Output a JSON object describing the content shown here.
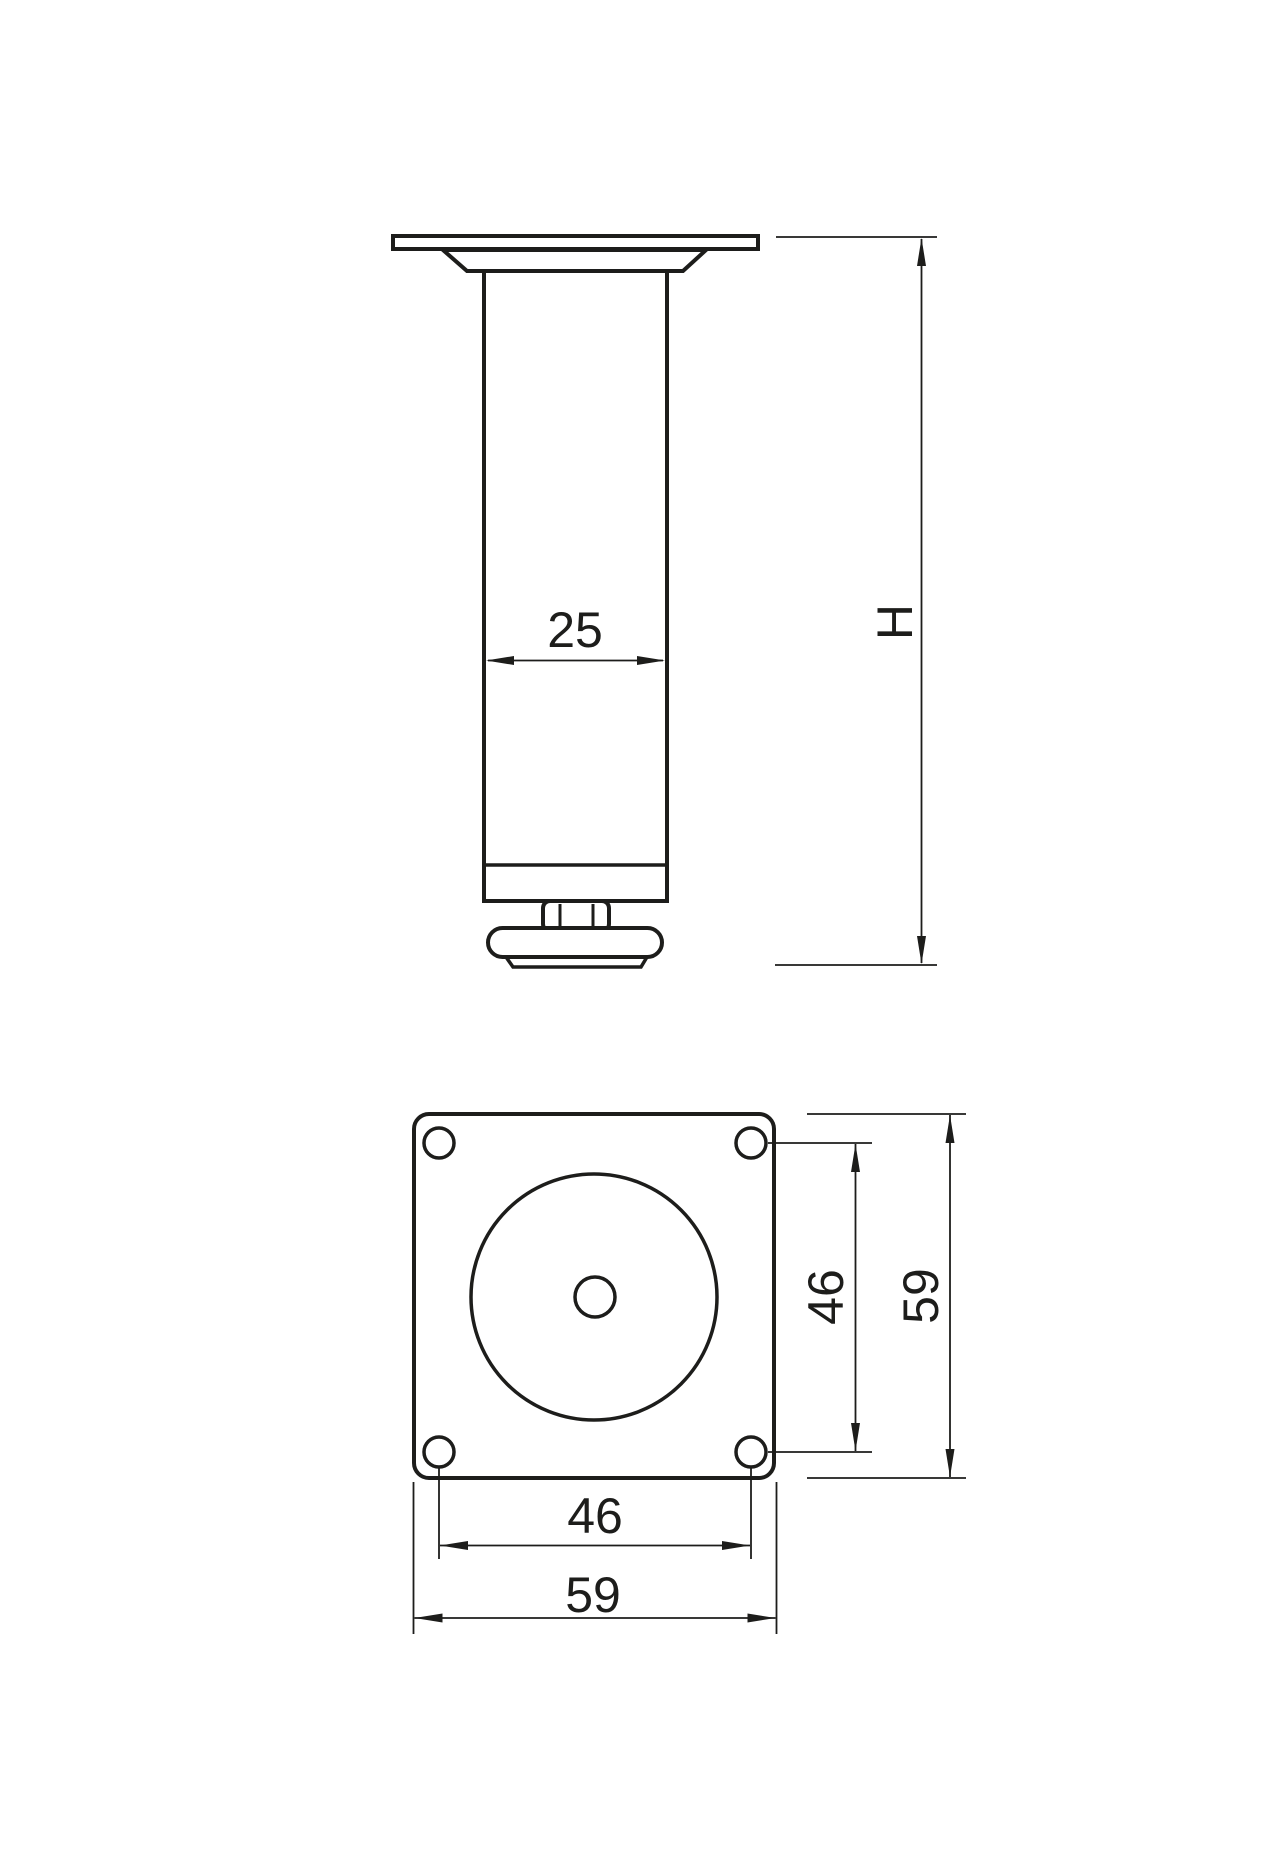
{
  "drawing": {
    "background_color": "#ffffff",
    "line_color": "#1d1d1b",
    "side_view": {
      "dim_tube_diameter": "25",
      "dim_overall_height": "H"
    },
    "plate_view": {
      "dim_hole_spacing_vertical": "46",
      "dim_plate_size_vertical": "59",
      "dim_hole_spacing_horizontal": "46",
      "dim_plate_size_horizontal": "59"
    }
  }
}
